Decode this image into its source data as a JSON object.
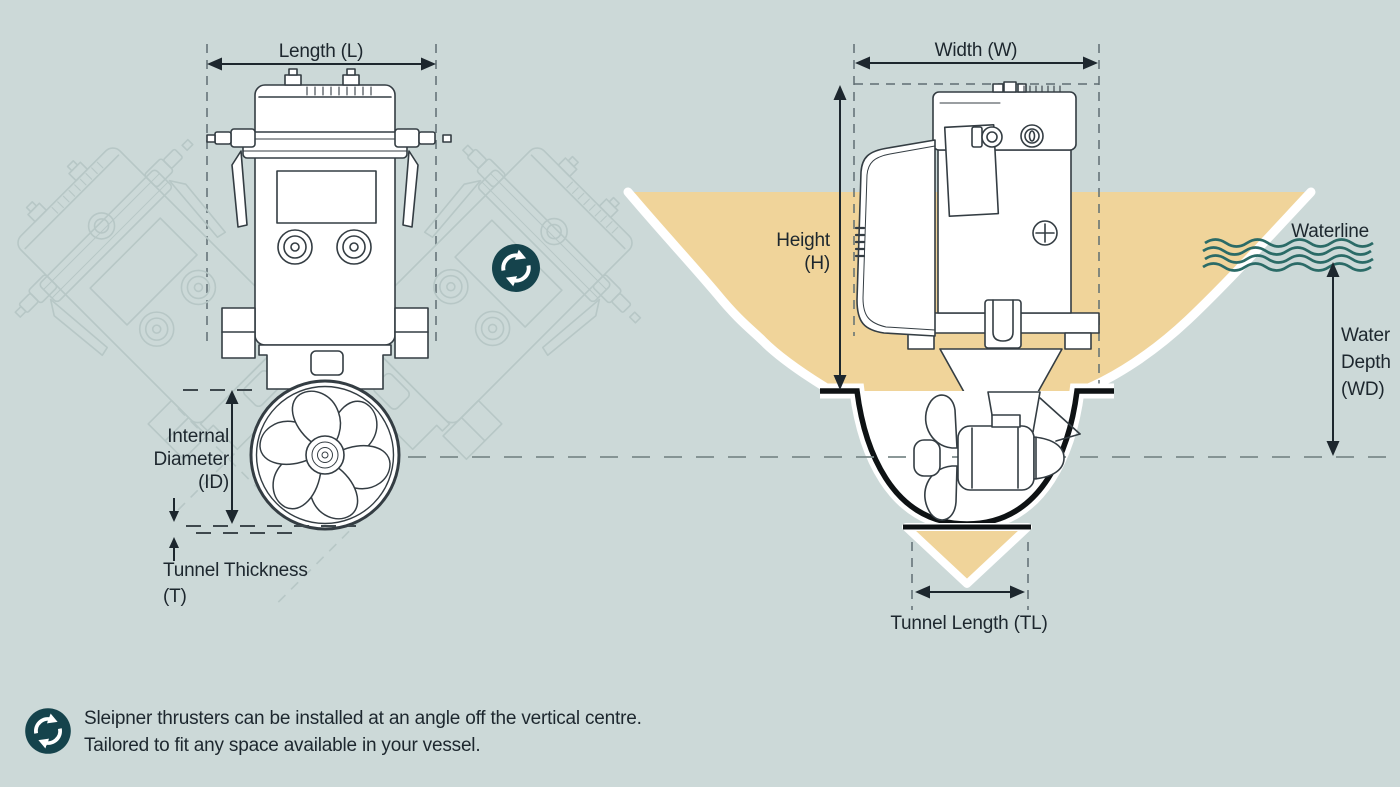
{
  "colors": {
    "background": "#ccd9d8",
    "hull_fill": "#f0d49a",
    "icon_teal": "#15434c",
    "wave_teal": "#2b6b67",
    "text": "#1d272e",
    "drawing_line": "#343d43",
    "ghost_line": "#b7c7c6"
  },
  "left_view": {
    "length_label": "Length (L)",
    "internal_diameter_lines": [
      "Internal",
      "Diameter",
      "(ID)"
    ],
    "tunnel_thickness_lines": [
      "Tunnel Thickness",
      "(T)"
    ]
  },
  "right_view": {
    "width_label": "Width (W)",
    "height_lines": [
      "Height",
      "(H)"
    ],
    "waterline_label": "Waterline",
    "water_depth_lines": [
      "Water",
      "Depth",
      "(WD)"
    ],
    "tunnel_length_label": "Tunnel Length (TL)"
  },
  "footer": {
    "lines": [
      "Sleipner thrusters can be installed at an angle off the vertical centre.",
      "Tailored to fit any space available in your vessel."
    ]
  },
  "icons": {
    "rotate_center": "rotate-arrows-icon",
    "rotate_footer": "rotate-arrows-icon"
  }
}
